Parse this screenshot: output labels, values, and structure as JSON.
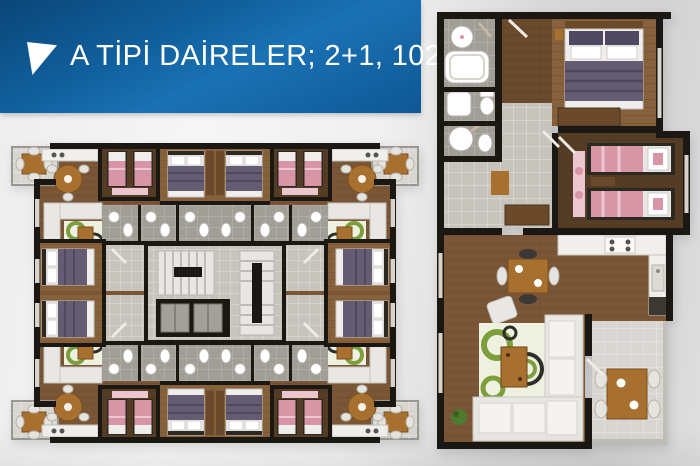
{
  "banner": {
    "title": "A TİPİ DAİRELER; 2+1, 102 m²",
    "icon": "triangle-marker-icon"
  },
  "plans": {
    "left_floor_plan": {
      "kind": "building typical floor plan",
      "apartments": 4,
      "rooms": [
        "balcony",
        "living room",
        "kitchen",
        "kids bedroom",
        "master bedroom",
        "bathroom",
        "hall",
        "stairs",
        "elevators"
      ]
    },
    "right_apartment_plan": {
      "kind": "single apartment detail plan",
      "rooms": [
        "bathroom",
        "wc",
        "master bedroom",
        "kids bedroom",
        "hall",
        "kitchen",
        "living room",
        "balcony"
      ]
    }
  },
  "colors": {
    "bannerStart": "#0a4679",
    "bannerMid1": "#11619f",
    "bannerMid2": "#1a72b4",
    "bannerEnd": "#0e5795",
    "wall": "#1b1713",
    "woodLive": "#7a5636",
    "woodMaster": "#86613c",
    "woodMid": "#6b4a2c",
    "woodDark": "#553d25",
    "tileHall": "#c7c4bc",
    "tileBath": "#a19e96",
    "tileBalcony": "#d8d6d0",
    "counter": "#f1efec",
    "sofa": "#e9e7e3",
    "rugBase": "#eef0e0",
    "rugGreen": "#7c9e3c",
    "rugDark": "#2e2e28",
    "bedPurple": "#645c72",
    "bedPurpleDark": "#4e4860",
    "pillow": "#efeeec",
    "bedPink": "#d795a6",
    "bedPinkLight": "#ecc6cf",
    "tableWood": "#a8702e",
    "stairLight": "#e7e6e2",
    "stairStripe": "#bdbcb8",
    "elevatorDoor": "#a3a09b",
    "plantGreen": "#4e7a2e",
    "window": "#d9d3cb",
    "door": "#f0ebe4",
    "chairWhite": "#e6e4df",
    "chairDark": "#3b3936",
    "frameDark": "#2c2822"
  }
}
